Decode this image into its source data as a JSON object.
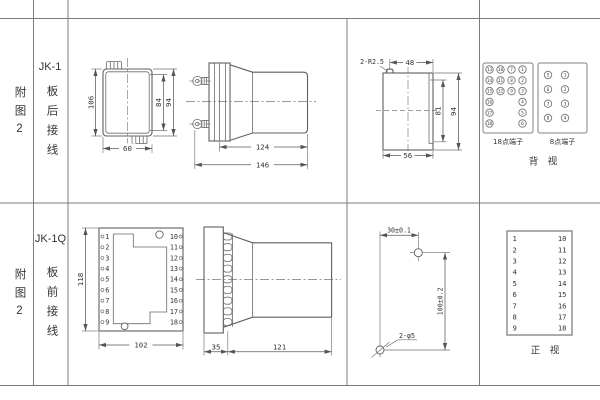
{
  "colors": {
    "background": "#ffffff",
    "grid_line": "#7d7d7d",
    "drawing_line": "#5f5f5f",
    "text": "#333333"
  },
  "row1": {
    "fig_label": "附图2",
    "model": "JK-1",
    "wiring_label": "板后接线",
    "front_view": {
      "dim_height": "106",
      "dim_inner_height": "84",
      "dim_overall_height": "94",
      "dim_width": "60"
    },
    "side_view": {
      "dim_body_depth": "124",
      "dim_overall_depth": "146"
    },
    "rear_view": {
      "corner_note": "2-R2.5",
      "dim_top_width": "48",
      "dim_inner_height": "81",
      "dim_overall_height": "94",
      "dim_bottom_width": "56"
    },
    "terminal18": {
      "label": "18点端子",
      "pins": [
        "13",
        "10",
        "7",
        "1",
        "14",
        "11",
        "8",
        "2",
        "15",
        "12",
        "9",
        "3",
        "16",
        "4",
        "17",
        "5",
        "18",
        "6"
      ]
    },
    "terminal8": {
      "label": "8点端子",
      "pins": [
        "5",
        "1",
        "6",
        "2",
        "7",
        "3",
        "8",
        "4"
      ]
    },
    "view_label": "背　视"
  },
  "row2": {
    "fig_label": "附图2",
    "model": "JK-1Q",
    "wiring_label": "板前接线",
    "front_view": {
      "dim_height": "118",
      "dim_width": "102",
      "left_pins": [
        "1",
        "2",
        "3",
        "4",
        "5",
        "6",
        "7",
        "8",
        "9"
      ],
      "right_pins": [
        "10",
        "11",
        "12",
        "13",
        "14",
        "15",
        "16",
        "17",
        "18"
      ]
    },
    "side_view": {
      "dim_plate_depth": "35",
      "dim_body_depth": "121"
    },
    "drill_view": {
      "dim_horizontal": "30±0.1",
      "dim_vertical": "100±0.2",
      "hole_note": "2-φ5"
    },
    "pin_table": {
      "left": [
        "1",
        "2",
        "3",
        "4",
        "5",
        "6",
        "7",
        "8",
        "9"
      ],
      "right": [
        "10",
        "11",
        "12",
        "13",
        "14",
        "15",
        "16",
        "17",
        "18"
      ]
    },
    "view_label": "正　视"
  }
}
